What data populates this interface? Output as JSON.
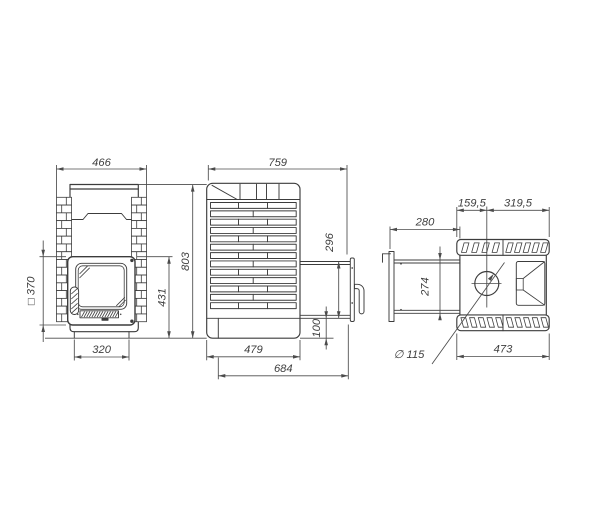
{
  "drawing": {
    "type": "technical-drawing",
    "subject": "wood-fired sauna stove, three orthographic views with dimensions",
    "background_color": "#ffffff",
    "line_color": "#3c3c3c",
    "dimension_color": "#4b4b4b",
    "views": {
      "front": {
        "name": "front view",
        "dims": {
          "overall_width": "466",
          "door_square": "□ 370",
          "base_width": "320",
          "door_top_to_floor": "431",
          "overall_height": "803"
        }
      },
      "side": {
        "name": "side view",
        "dims": {
          "overall_depth": "759",
          "tunnel_opening_height": "296",
          "tunnel_bottom_offset": "100",
          "body_depth": "479",
          "depth_with_tunnel": "684"
        }
      },
      "top": {
        "name": "top view",
        "dims": {
          "front_to_flue_center": "159,5",
          "flue_center_to_back": "319,5",
          "tunnel_length": "280",
          "tunnel_width": "274",
          "body_width": "473",
          "flue_diameter": "∅ 115"
        }
      }
    }
  }
}
